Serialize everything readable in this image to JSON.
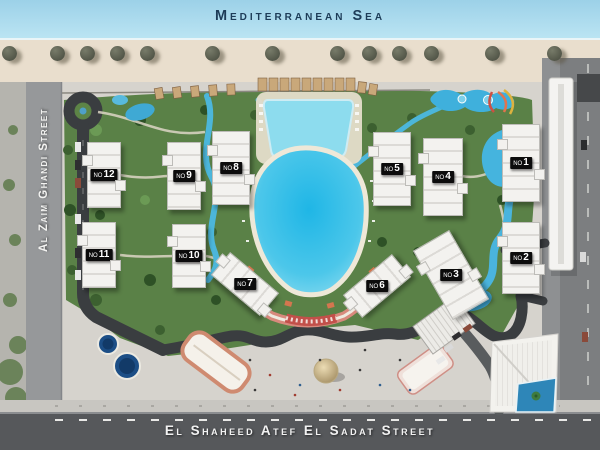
{
  "map": {
    "sea_label": "Mediterranean Sea",
    "left_street_label": "Al Zaim Ghandi Street",
    "bottom_street_label": "El Shaheed Atef El Sadat Street"
  },
  "buildings": {
    "label_prefix": "NO",
    "items": [
      {
        "number": "1",
        "x": 521,
        "y": 163,
        "w": 36,
        "h": 76,
        "rot": 0
      },
      {
        "number": "2",
        "x": 521,
        "y": 258,
        "w": 36,
        "h": 70,
        "rot": 0
      },
      {
        "number": "3",
        "x": 451,
        "y": 275,
        "w": 40,
        "h": 78,
        "rot": -30
      },
      {
        "number": "4",
        "x": 443,
        "y": 177,
        "w": 38,
        "h": 76,
        "rot": 0
      },
      {
        "number": "5",
        "x": 392,
        "y": 169,
        "w": 36,
        "h": 72,
        "rot": 0
      },
      {
        "number": "6",
        "x": 377,
        "y": 286,
        "w": 62,
        "h": 28,
        "rot": -40
      },
      {
        "number": "7",
        "x": 245,
        "y": 284,
        "w": 62,
        "h": 28,
        "rot": 40
      },
      {
        "number": "8",
        "x": 231,
        "y": 168,
        "w": 36,
        "h": 72,
        "rot": 0
      },
      {
        "number": "9",
        "x": 184,
        "y": 176,
        "w": 32,
        "h": 66,
        "rot": 0
      },
      {
        "number": "10",
        "x": 189,
        "y": 256,
        "w": 32,
        "h": 62,
        "rot": 0
      },
      {
        "number": "11",
        "x": 99,
        "y": 255,
        "w": 32,
        "h": 64,
        "rot": 0
      },
      {
        "number": "12",
        "x": 104,
        "y": 175,
        "w": 32,
        "h": 64,
        "rot": 0
      }
    ]
  },
  "beach": {
    "umbrella_x": [
      2,
      50,
      80,
      110,
      140,
      205,
      265,
      330,
      362,
      392,
      424,
      485,
      547
    ]
  },
  "colors": {
    "sea": "#a6d7ea",
    "sand": "#e9decd",
    "pavement": "#d6d3cd",
    "grass": "#5a8147",
    "lagoon": "#23b9e6",
    "pool": "#8ddcee",
    "internal_road": "#3a3d40",
    "street": "#96989a",
    "street_dark": "#56585b",
    "walkway_pink": "#d8897c",
    "colonnade_red": "#c2504a",
    "building": "#f2f1ee",
    "label_bg": "#0c0c0c",
    "label_text": "#ffffff",
    "sea_text": "#1d3c58",
    "street_text": "#f2f2f2"
  }
}
